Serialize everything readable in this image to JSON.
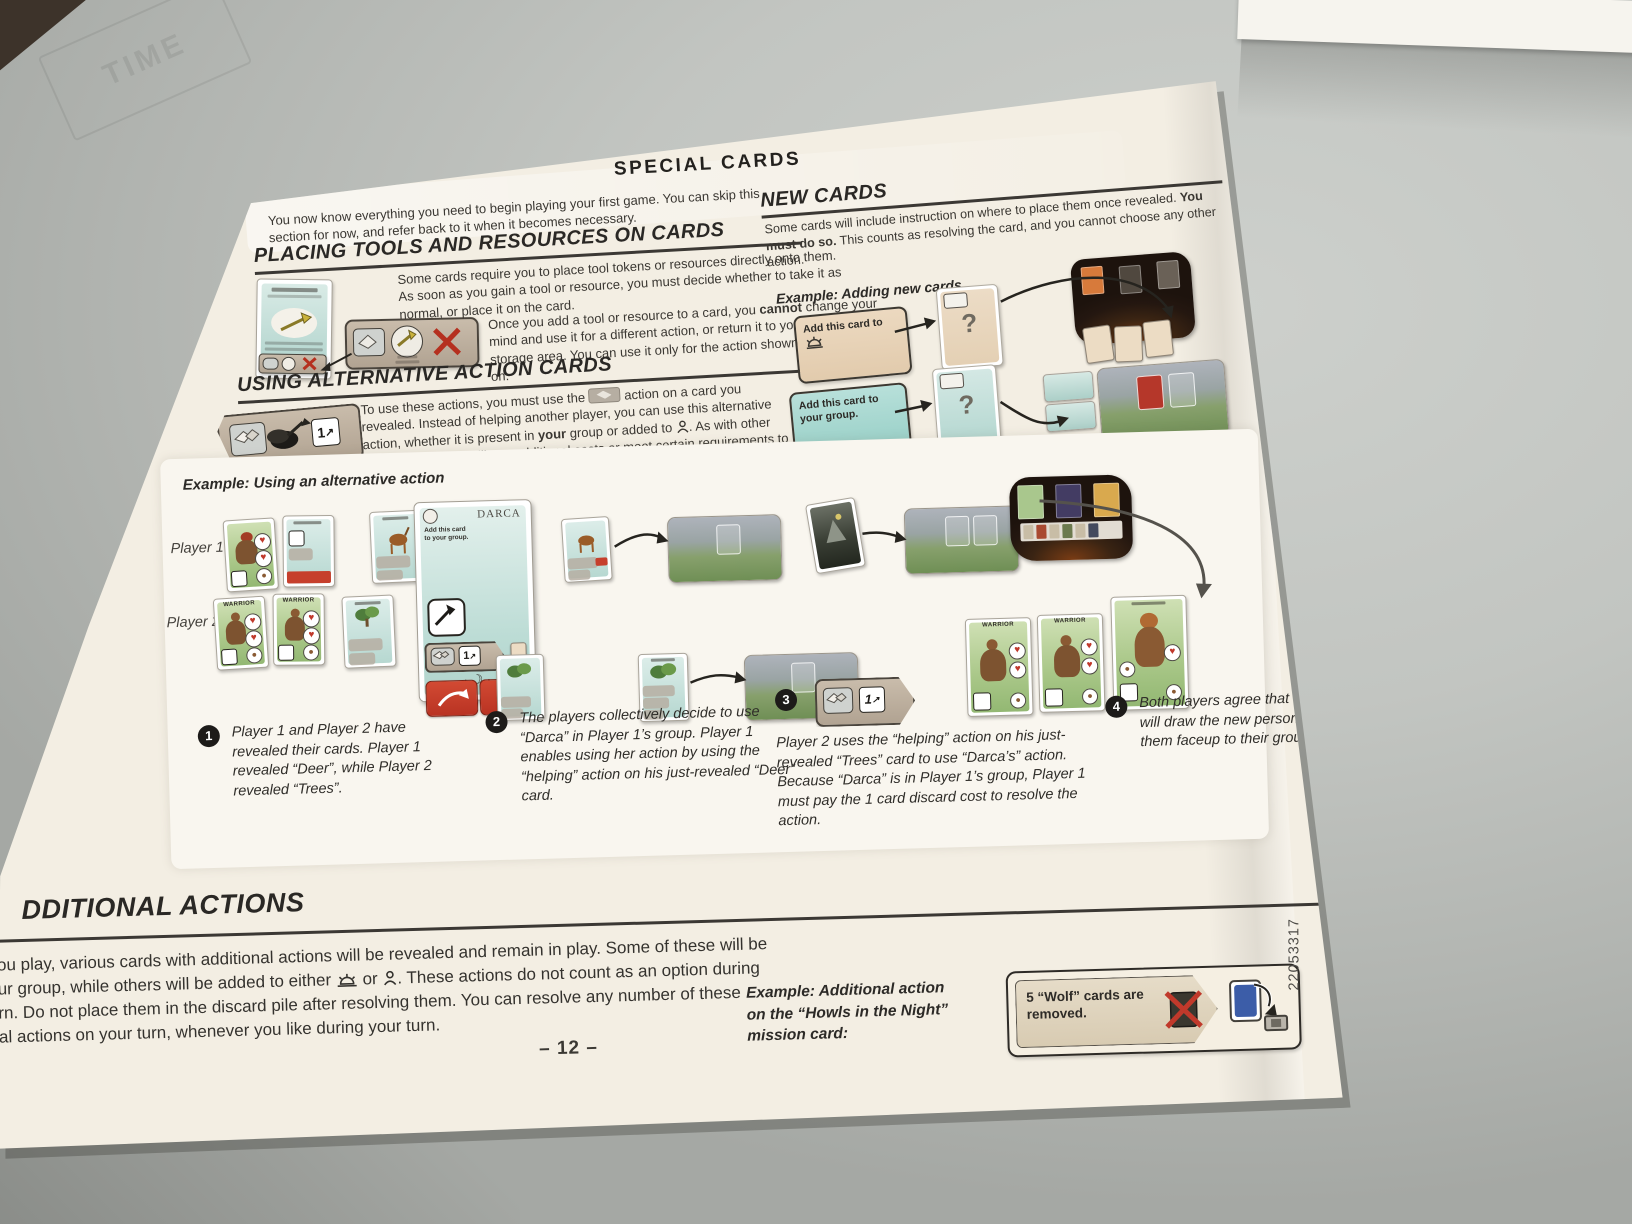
{
  "photo": {
    "stamp_text": "TIME"
  },
  "icons": {
    "handshake": "handshake-chip",
    "sun": "sunrise",
    "person": "person-silhouette",
    "stones": "stone-stack",
    "moon": "☽",
    "heart": "♥",
    "skull": "☠",
    "spear": "spear",
    "red_x": "✗",
    "arrow_ne": "↗",
    "acorn": "●"
  },
  "page": {
    "title": "SPECIAL CARDS",
    "intro": "You now know everything you need to begin playing your first game. You can skip this section for now, and refer back to it when it becomes necessary.",
    "placing": {
      "heading": "PLACING TOOLS AND RESOURCES ON CARDS",
      "para1": "Some cards require you to place tool tokens or resources directly onto them. As soon as you gain a tool or resource, you must decide whether to take it as normal, or place it on the card.",
      "p2_s1": "Once you add a tool or resource to a card, you ",
      "p2_b1": "cannot",
      "p2_s2": " change your mind and use it for a different action, or return it to your group or the storage area. You can use it only for the action shown on the card it is on."
    },
    "using": {
      "heading": "USING ALTERNATIVE ACTION CARDS",
      "p1_s1": "To use these actions, you must use the ",
      "p1_s2": " action on a card you revealed. Instead of helping another player, you can use this alternative action, whether it is present in ",
      "p1_b1": "your",
      "p1_s3": " group or added to ",
      "p1_s4": ". As with other actions, you must still pay additional costs or meet certain requirements to receive any rewards. ",
      "p1_b2": "Do not",
      "p1_s5": " place the card in the discard pile after using this action.",
      "p2_s1": "If you want to use this type of action on another player’s card, that player ",
      "p2_b1": "must choose to help you",
      "p2_s2": " by also using a ",
      "p2_s3": " action."
    },
    "new_cards": {
      "heading": "NEW CARDS",
      "p_s1": "Some cards will include instruction on where to place them once revealed. ",
      "p_b1": "You must do so.",
      "p_s2": " This counts as resolving the card, and you cannot choose any other action.",
      "example_label": "Example: Adding new cards",
      "box1_text": "Add this card to",
      "box2_text": "Add this card to your group.",
      "box3_text": "Add this card to",
      "facedown_mark": "?"
    },
    "example_alt": {
      "label": "Example: Using an alternative action",
      "player1": "Player 1",
      "player2": "Player 2",
      "darca_title": "DARCA",
      "darca_text": "Add this card to your group.",
      "warrior_title": "WARRIOR",
      "cost_badge": "1"
    },
    "captions": {
      "n1": "1",
      "t1": "Player 1 and Player 2 have revealed their cards. Player 1 revealed “Deer”, while Player 2 revealed “Trees”.",
      "n2": "2",
      "t2": "The players collectively decide to use “Darca” in Player 1’s group. Player 1 enables using her action by using the “helping” action on his just-revealed “Deer” card.",
      "n3": "3",
      "t3": "Player 2 uses the “helping” action on his just-revealed “Trees” card to use “Darca’s” action. Because “Darca” is in Player 1’s group, Player 1 must pay the 1 card discard cost to resolve the action.",
      "n4": "4",
      "t4": "Both players agree that Player 2 will draw the new person, adding them faceup to their group."
    },
    "additional": {
      "heading_visible": "DDITIONAL ACTIONS",
      "l1": "ou play, various cards with additional actions will be revealed and remain in play. Some of these will be",
      "l2_s1": "ur group, while others will be added to either ",
      "l2_or": " or ",
      "l2_s3": ". These actions do not count as an option during",
      "l3": "rn. Do not place them in the discard pile after resolving them. You can resolve any number of these",
      "l4": "al actions on your turn, whenever you like during your turn.",
      "e_l1": "Example: Additional action",
      "e_l2": "on the “Howls in the Night”",
      "e_l3": "mission card:",
      "wolf_text": "5 “Wolf” cards are removed."
    },
    "page_number": "– 12 –",
    "print_code": "22053317"
  }
}
